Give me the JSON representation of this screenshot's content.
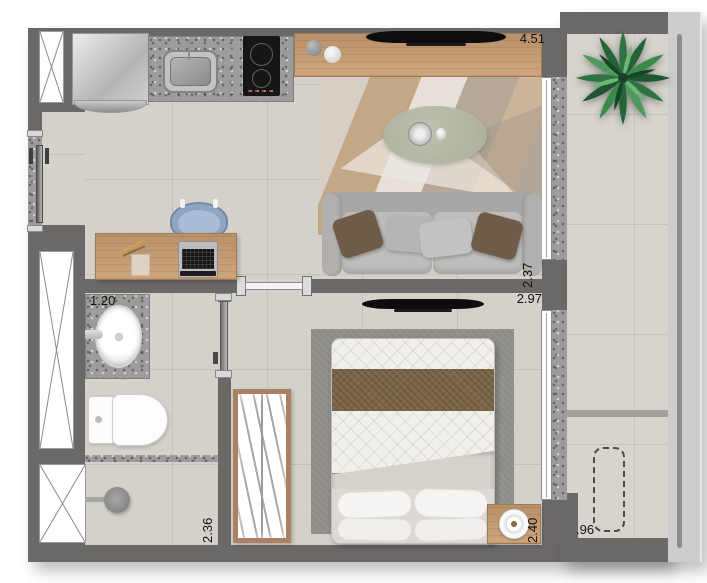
{
  "plan": {
    "labels": {
      "dim_top": "4.51",
      "dim_living_right": "2.37",
      "dim_bedroom_top": "2.97",
      "dim_bedroom_right": "2.40",
      "dim_bath_top": "1.20",
      "dim_bath_bottom": "2.36",
      "dim_balcony": ".96"
    },
    "colors": {
      "wall": "#6b6868",
      "floor": "#d4d1cb",
      "balcony_floor": "#d7d4ce",
      "granite": "#9c9c9c",
      "wood": "#c79b70",
      "label_text": "#111111",
      "railing": "#cdcdcd",
      "sofa_gray": "#bcbab8",
      "pillow_brown": "#6f5b48",
      "runner_brown": "#7c6648",
      "plant_green": "#2e7342",
      "chair_blue": "#8ea6c4",
      "rug_bedroom": "#8f8d8a",
      "table_sage": "#b6b9a7"
    }
  }
}
